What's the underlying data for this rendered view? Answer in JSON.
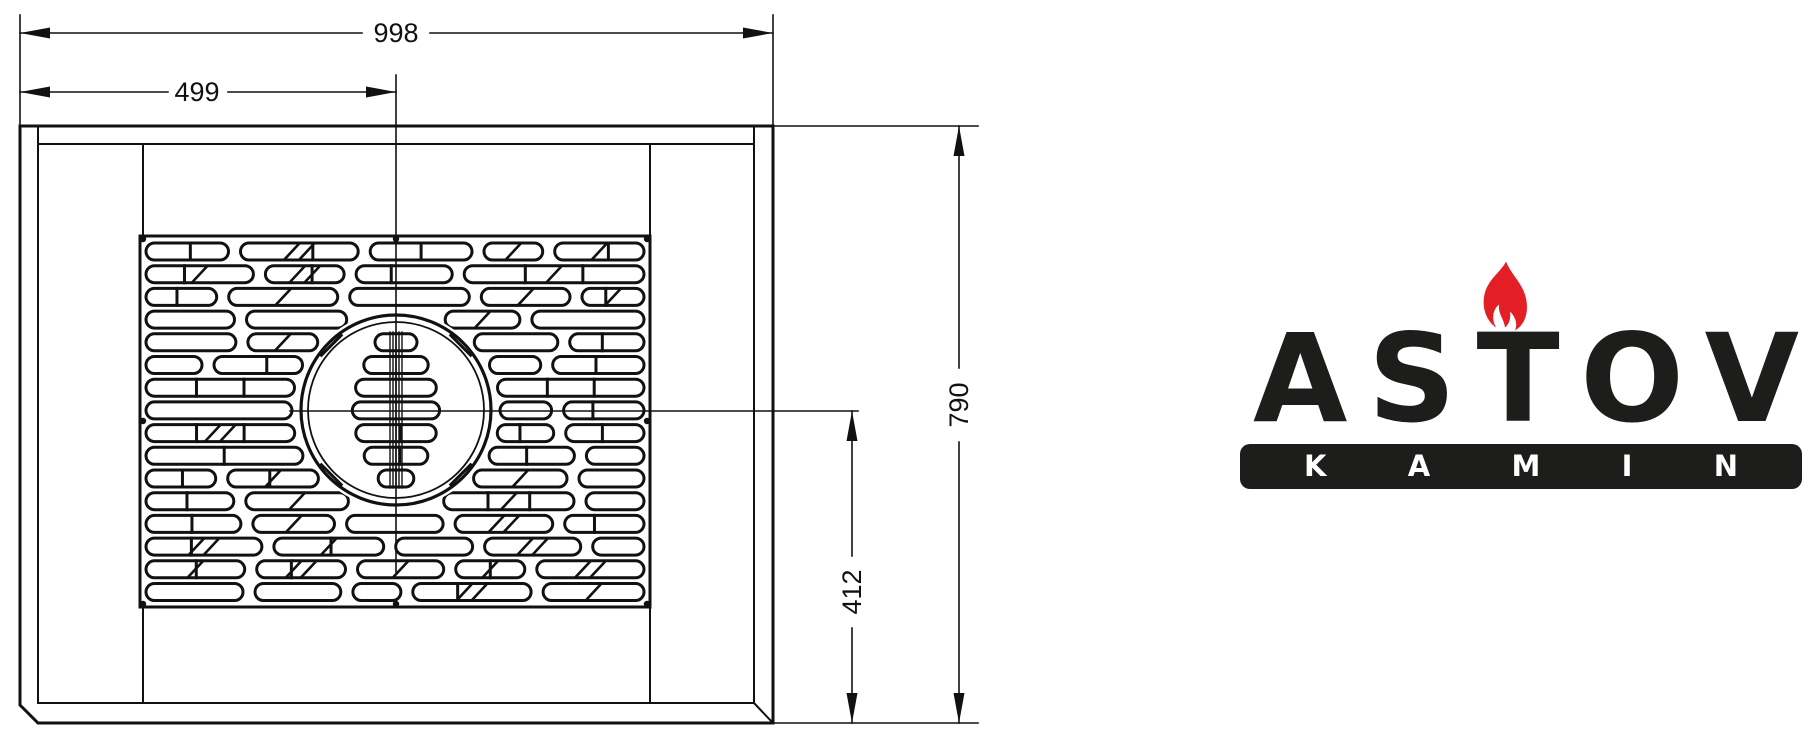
{
  "drawing": {
    "dims": {
      "total_width": "998",
      "half_width": "499",
      "total_depth": "790",
      "center_depth": "412"
    },
    "line_color": "#111111",
    "background": "#ffffff"
  },
  "logo": {
    "brand": "ASTOV",
    "brand_letters": [
      "A",
      "S",
      "T",
      "O",
      "V"
    ],
    "subtitle": "KAMIN",
    "subtitle_letters": [
      "K",
      "A",
      "M",
      "I",
      "N"
    ],
    "text_color": "#1d1d1b",
    "flame_color": "#e31e24",
    "bar_text_color": "#ffffff"
  }
}
